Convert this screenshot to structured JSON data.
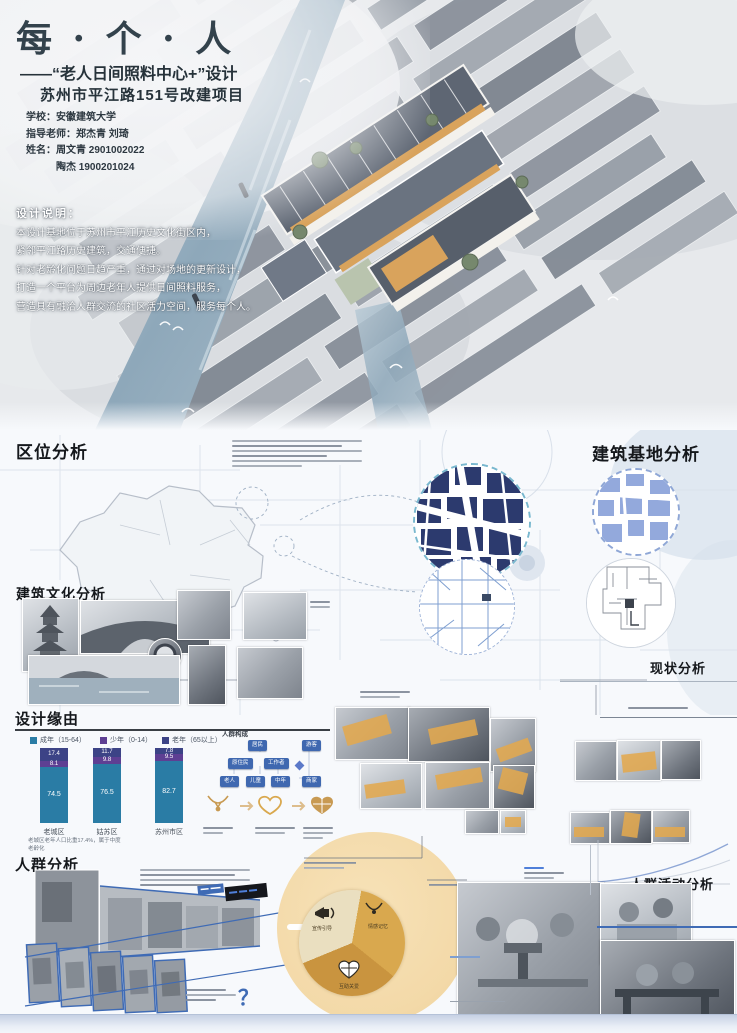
{
  "poster": {
    "title": "每 · 个 · 人",
    "subtitle_line1": "——“老人日间照料中心+”设计",
    "subtitle_line2": "苏州市平江路151号改建项目",
    "credits": [
      "学校：安徽建筑大学",
      "指导老师：郑杰青  刘琦",
      "姓名：周文青  2901002022",
      "　　　陶杰  1900201024"
    ],
    "design_note": {
      "heading": "设计说明：",
      "lines": [
        "本设计基地位于苏州市平江历史文化街区内，",
        "紧邻平江路历史建筑，交通便捷。",
        "针对老龄化问题日趋严重，通过对场地的更新设计，",
        "打造一个平台为周边老年人提供日间照料服务，",
        "营造具有融洽人群交流的社区活力空间，服务每个人。"
      ]
    }
  },
  "sections": {
    "location": "区位分析",
    "site": "建筑基地分析",
    "culture": "建筑文化分析",
    "status": "现状分析",
    "rationale": "设计缘由",
    "crowd": "人群分析",
    "activity": "人群活动分析",
    "crowd_composition": "人群构成"
  },
  "chart_data": [
    {
      "type": "bar",
      "subtype": "stacked-percent",
      "section": "设计缘由",
      "categories": [
        "老城区",
        "姑苏区",
        "苏州市区"
      ],
      "series": [
        {
          "name": "老年（65以上）",
          "color": "#3c4386",
          "values": [
            17.4,
            11.7,
            7.8
          ]
        },
        {
          "name": "少年（0-14）",
          "color": "#5e3f93",
          "values": [
            8.1,
            9.8,
            9.5
          ]
        },
        {
          "name": "成年（15-64）",
          "color": "#2a7ca5",
          "values": [
            74.5,
            76.5,
            82.7
          ]
        }
      ],
      "legend_position": "top",
      "ylim": [
        0,
        100
      ],
      "footnote": "老城区老年人口比重17.4%，属于中度老龄化"
    },
    {
      "type": "pie",
      "labels": [
        "宣传引导",
        "情感记忆",
        "互助关爱"
      ],
      "values": [
        33,
        33,
        34
      ],
      "colors": [
        "#eadfc0",
        "#d9a84e",
        "#c9943f"
      ],
      "icons": [
        "megaphone-icon",
        "necklace-icon",
        "heart-puzzle-icon"
      ]
    }
  ],
  "crowd_composition": {
    "boxes": [
      "居民",
      "游客",
      "原住民",
      "工作者",
      "老人",
      "儿童",
      "中年",
      "商家"
    ]
  },
  "misc": {
    "question_mark": "？"
  },
  "colors": {
    "accent_blue": "#3f6bb5",
    "navy_map": "#2c3a6e",
    "tan_circle": "#f3d9a8",
    "amber": "#d9a84e",
    "bar_teal": "#2a7ca5",
    "bar_purple": "#5e3f93",
    "bar_navy": "#3c4386"
  }
}
